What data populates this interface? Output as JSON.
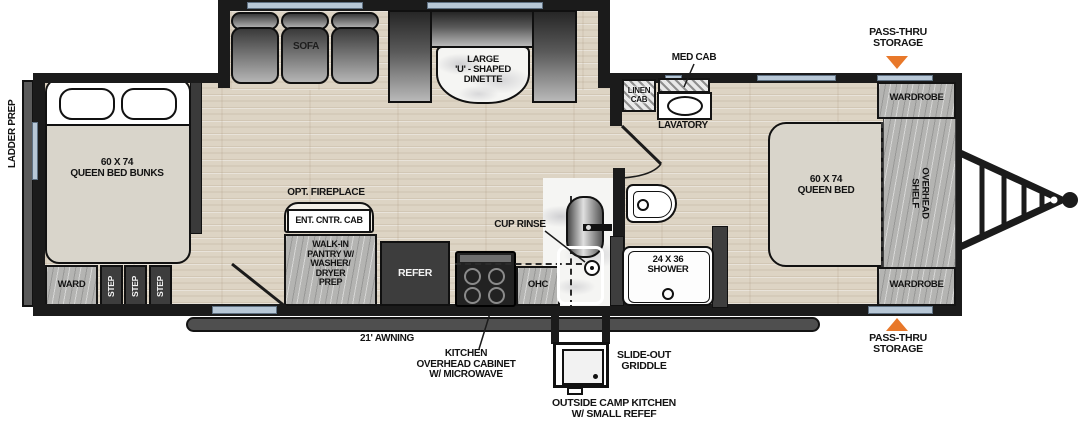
{
  "colors": {
    "wall": "#1b1b1b",
    "floor_wood": "#ddd4c4",
    "cabinet_wood": "#b4b4b2",
    "bench_dark": "#262626",
    "bench_light": "#b9b9b9",
    "bed_fill": "#d9d5cb",
    "window_blue": "#b7c7d6",
    "accent_orange": "#e8782a",
    "awning_bar": "#4f4f4f"
  },
  "exterior": {
    "ladder_prep": "LADDER PREP",
    "pass_thru_top": [
      "PASS-THRU",
      "STORAGE"
    ],
    "pass_thru_bottom": [
      "PASS-THRU",
      "STORAGE"
    ],
    "awning": "21' AWNING",
    "slide_out_griddle": [
      "SLIDE-OUT",
      "GRIDDLE"
    ],
    "outside_kitchen": [
      "OUTSIDE CAMP KITCHEN",
      "W/ SMALL REFEF"
    ]
  },
  "bunk_room": {
    "bed": [
      "60 X 74",
      "QUEEN BED BUNKS"
    ],
    "ward": "WARD",
    "steps": [
      "STEP",
      "STEP",
      "STEP"
    ]
  },
  "slide_out": {
    "sofa": "SOFA",
    "dinette": [
      "LARGE",
      "'U' - SHAPED",
      "DINETTE"
    ]
  },
  "kitchen": {
    "opt_fireplace": "OPT. FIREPLACE",
    "ent_cntr_cab": "ENT. CNTR. CAB",
    "walk_in_pantry": [
      "WALK-IN",
      "PANTRY W/",
      "WASHER/",
      "DRYER",
      "PREP"
    ],
    "refer": "REFER",
    "cup_rinse": "CUP RINSE",
    "ohc": "OHC",
    "kitchen_overhead": [
      "KITCHEN",
      "OVERHEAD CABINET",
      "W/ MICROWAVE"
    ]
  },
  "bathroom": {
    "linen_cab": [
      "LINEN",
      "CAB"
    ],
    "med_cab": "MED CAB",
    "lavatory": "LAVATORY",
    "shower": [
      "24 X 36",
      "SHOWER"
    ]
  },
  "bedroom": {
    "bed": [
      "60 X 74",
      "QUEEN BED"
    ],
    "overhead_shelf": [
      "OVERHEAD",
      "SHELF"
    ],
    "wardrobe_top": "WARDROBE",
    "wardrobe_bottom": "WARDROBE"
  }
}
